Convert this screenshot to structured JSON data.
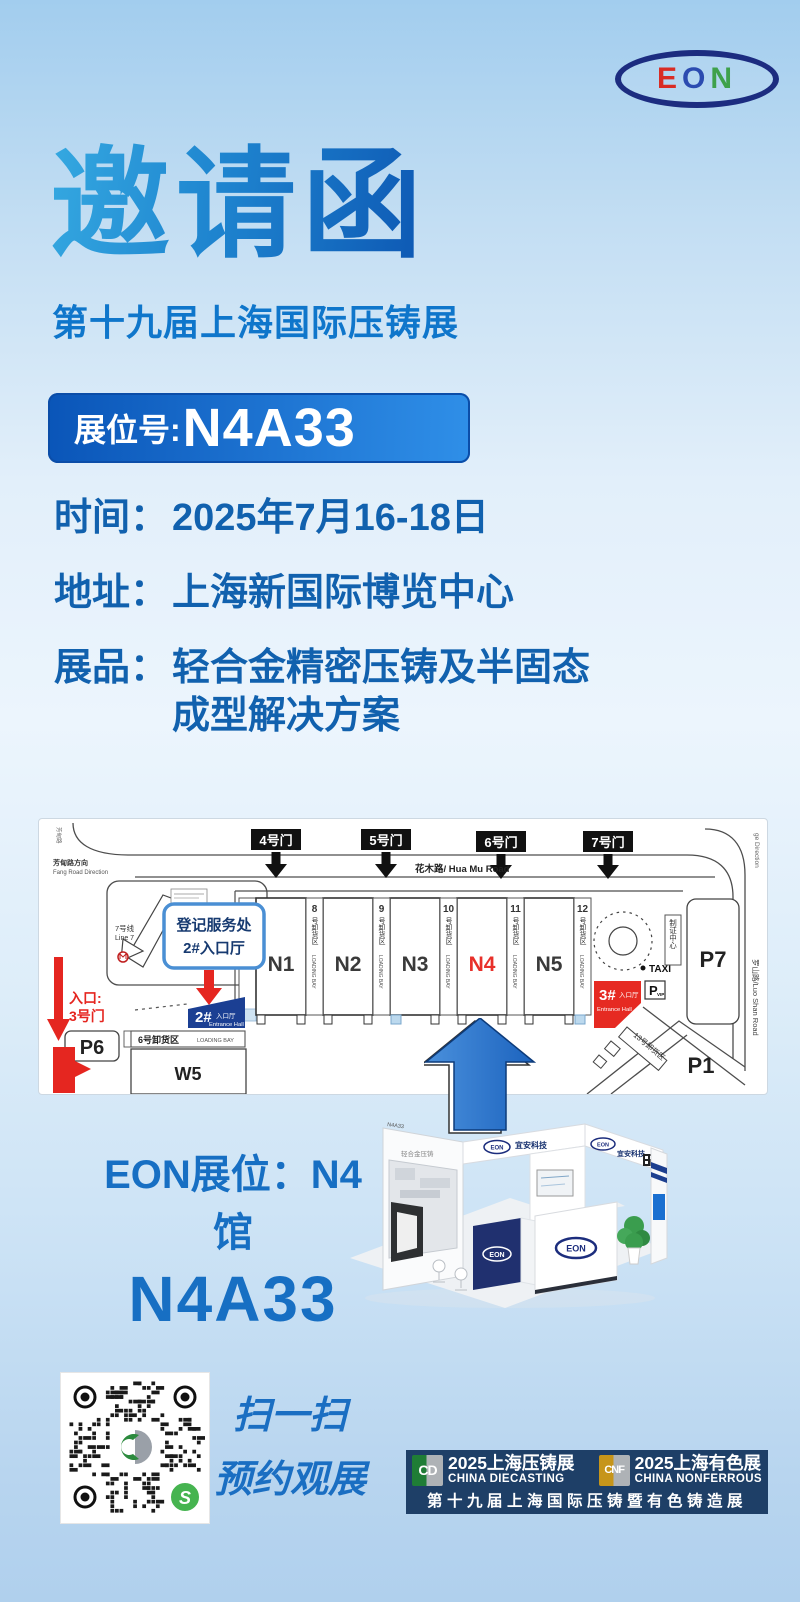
{
  "brand_logo": {
    "e": "E",
    "o": "O",
    "n": "N"
  },
  "hero": {
    "title": "邀请函",
    "subtitle": "第十九届上海国际压铸展",
    "badge_label": "展位号:",
    "badge_number": "N4A33"
  },
  "details": {
    "rows": [
      {
        "label": "时间：",
        "value": "2025年7月16-18日"
      },
      {
        "label": "地址：",
        "value": "上海新国际博览中心"
      },
      {
        "label": "展品：",
        "value": "轻合金精密压铸及半固态",
        "value2": "成型解决方案"
      }
    ]
  },
  "map": {
    "gates": [
      "4号门",
      "5号门",
      "6号门",
      "7号门"
    ],
    "road_top": "花木路/ Hua Mu Road",
    "road_right": "罗山路/Luo Shan Road",
    "corner_note": "ge Direction",
    "left_dir_cn": "芳甸路方向",
    "left_dir_en": "Fang Road Direction",
    "left_edge_vertical": "芳甸路",
    "metro_line": "7号线",
    "metro_line_en": "Line 7",
    "callout_line1": "登记服务处",
    "callout_line2": "2#入口厅",
    "entrance2_num": "2#",
    "entrance2_cn": "入口厅",
    "entrance2_en": "Entrance Hall",
    "entrance3_num": "3#",
    "entrance3_cn": "入口厅",
    "entrance3_en": "Entrance Hall",
    "entry_line1": "入口:",
    "entry_line2": "3号门",
    "halls": [
      "N1",
      "N2",
      "N3",
      "N4",
      "N5"
    ],
    "highlight_hall": "N4",
    "strips": [
      {
        "num": "8",
        "cn": "号卸货区",
        "en": "LOADING BAY"
      },
      {
        "num": "9",
        "cn": "号卸货区",
        "en": "LOADING BAY"
      },
      {
        "num": "10",
        "cn": "号卸货区",
        "en": "LOADING BAY"
      },
      {
        "num": "11",
        "cn": "号卸货区",
        "en": "LOADING BAY"
      },
      {
        "num": "12",
        "cn": "号卸货区",
        "en": "LOADING BAY"
      }
    ],
    "left_bay_en": "LOADING BAY",
    "bay6_cn": "6号卸货区",
    "bay6_en": "LOADING BAY",
    "bay13": "13号卸货区",
    "w5": "W5",
    "p1": "P1",
    "p6": "P6",
    "p7": "P7",
    "taxi": "TAXI",
    "p_vip": "P",
    "p_vip_sub": "VIP",
    "cert_center": "制证中心"
  },
  "booth": {
    "render": {
      "brand": "宜安科技",
      "logo": "EON",
      "booth_no": "N4A33",
      "wall_text": "轻合金压铸"
    },
    "hall_line": "EON展位：N4馆",
    "booth_line": "N4A33"
  },
  "footer": {
    "scan_line1": "扫一扫",
    "scan_line2": "预约观展",
    "qr_badge": "S",
    "banner": {
      "left": {
        "logo": "CD",
        "line1": "2025上海压铸展",
        "line2": "CHINA DIECASTING"
      },
      "right": {
        "logo": "CNF",
        "line1": "2025上海有色展",
        "line2": "CHINA NONFERROUS"
      },
      "bottom": "第十九届上海国际压铸暨有色铸造展"
    }
  }
}
